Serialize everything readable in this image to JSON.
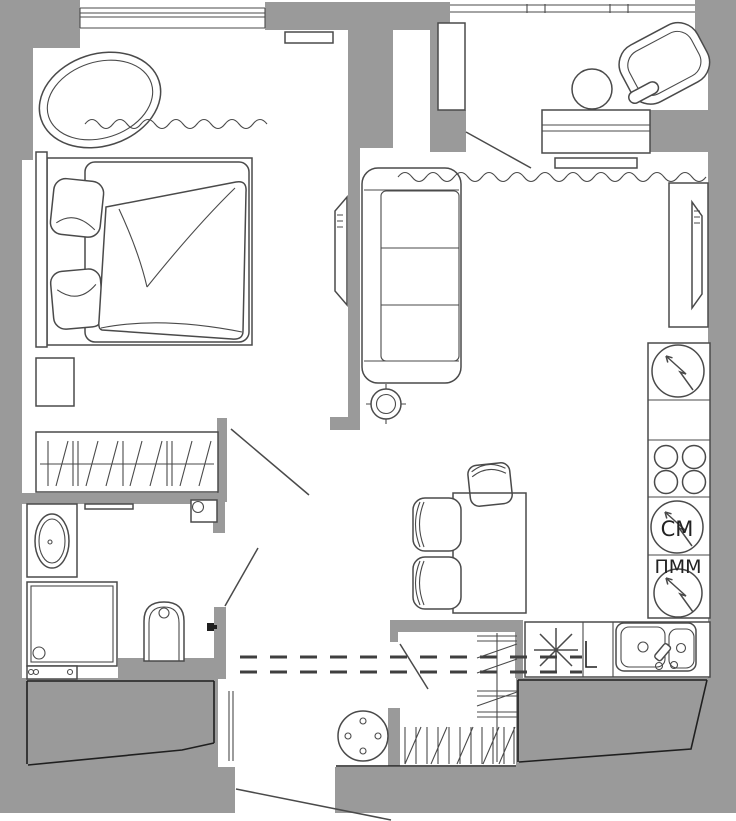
{
  "title": "apartment-floor-plan",
  "labels": {
    "washer": "СМ",
    "dishwasher": "ПММ"
  },
  "colors": {
    "wall": "#9a9a9a",
    "line": "#4a4a4a",
    "dark": "#1f1f1f",
    "bg": "#ffffff"
  },
  "icons": {
    "fridge": "fridge-circle-arrow-symbol",
    "hob": "hob-four-burners-symbol",
    "washer": "washing-machine-circle-arrow-symbol",
    "dishwasher": "dishwasher-circle-arrow-symbol",
    "cooktop_star": "eight-ray-star-symbol",
    "sink": "double-bowl-sink-symbol",
    "bed": "double-bed-symbol",
    "sofa": "three-seat-sofa-symbol",
    "armchair": "armchair-symbol",
    "toilet": "wall-hung-toilet-symbol",
    "shower": "shower-tray-symbol",
    "vanity": "vanity-oval-basin-symbol",
    "tv": "wall-tv-symbol",
    "rug": "oval-rug-symbol",
    "pouf": "round-pouf-symbol",
    "lamp": "floor-lamp-crosshair-symbol",
    "curtain": "wavy-curtain-symbol",
    "wardrobe": "wardrobe-hanging-clothes-symbol"
  }
}
